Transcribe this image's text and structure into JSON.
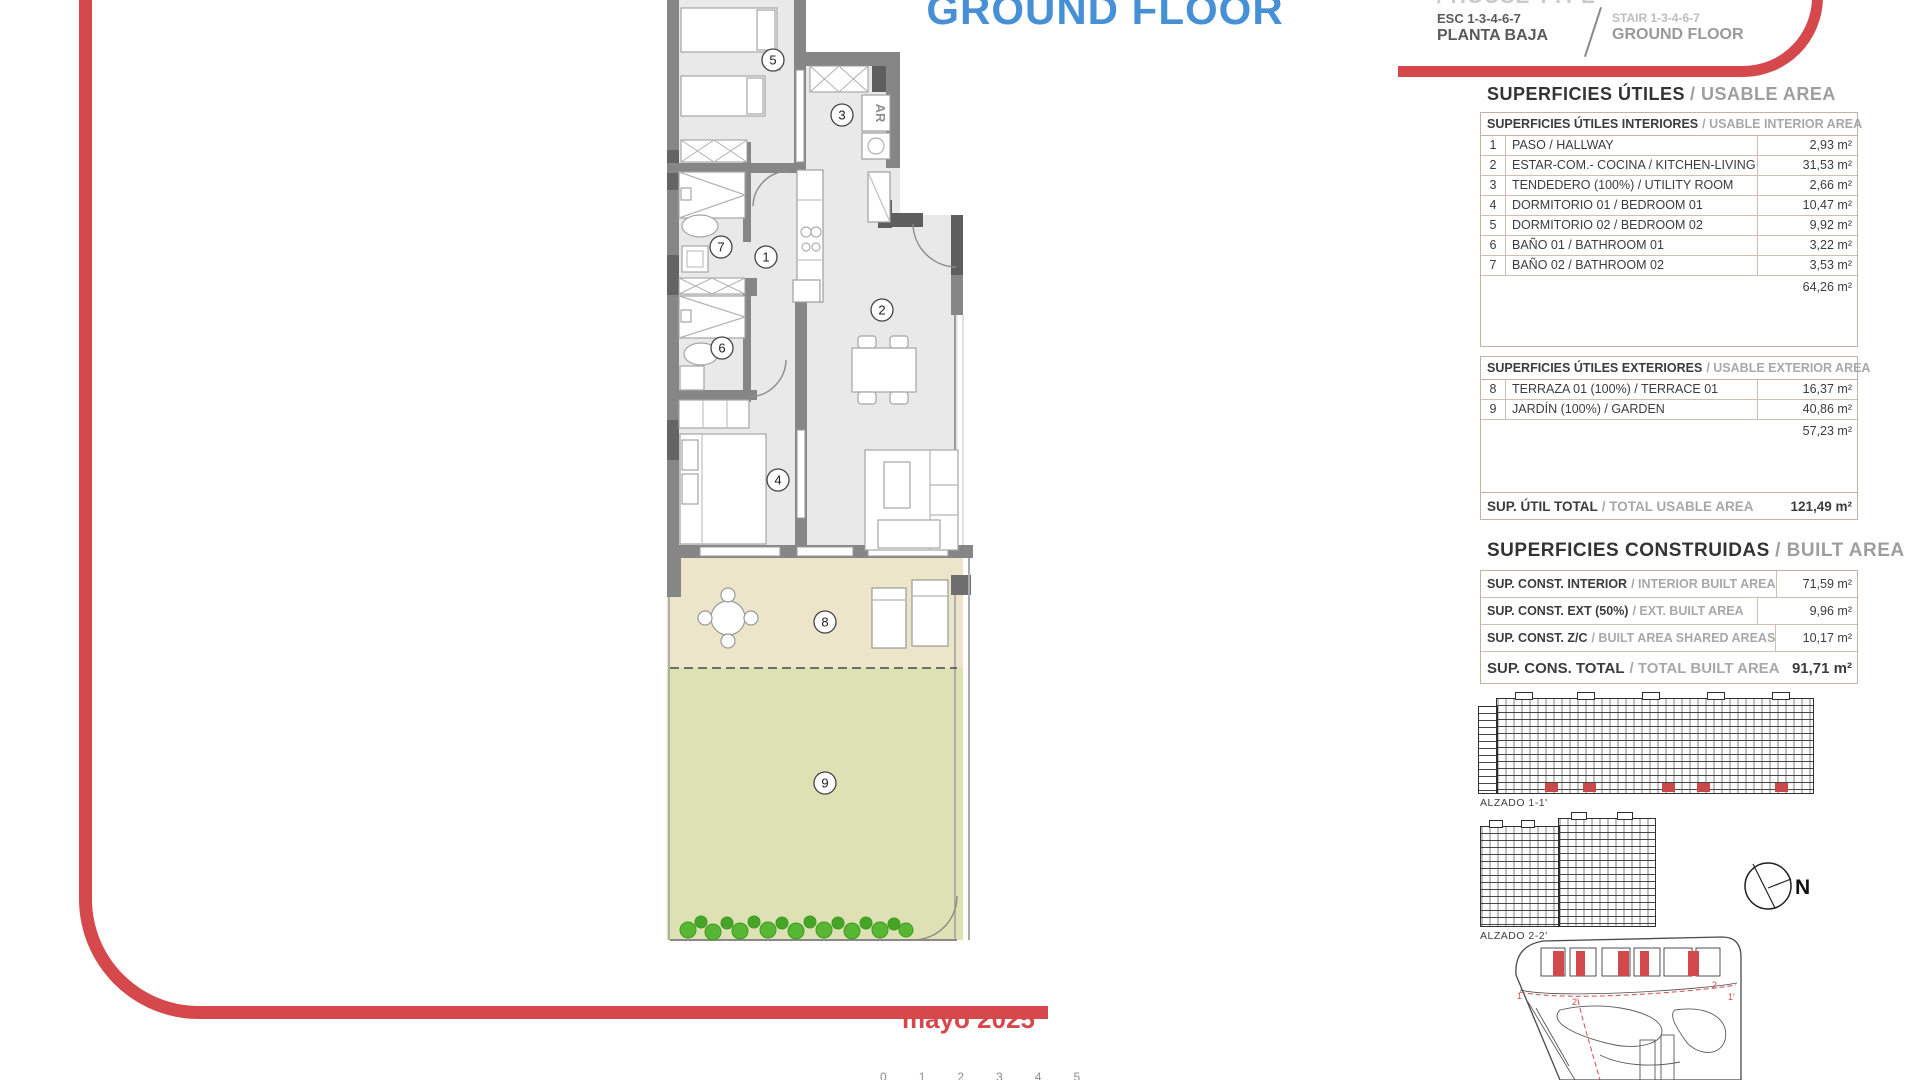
{
  "colors": {
    "accent_red": "#d5494d",
    "title_blue": "#4690d6",
    "terrace_fill": "#ece5c9",
    "garden_fill": "#dee1b3",
    "shrub_green": "#57b733"
  },
  "header": {
    "title": "GROUND FLOOR",
    "house_type_cut": "/ HOUSE TYPE",
    "badge": "1B",
    "esc_label": "ESC 1-3-4-6-7",
    "esc_sub": "PLANTA BAJA",
    "stair_label": "STAIR 1-3-4-6-7",
    "stair_sub": "GROUND FLOOR"
  },
  "usable": {
    "heading_es": "SUPERFICIES ÚTILES",
    "heading_en": "/ USABLE AREA",
    "interior_header_es": "SUPERFICIES ÚTILES INTERIORES",
    "interior_header_en": "/ USABLE INTERIOR AREA",
    "interior_rows": [
      {
        "num": "1",
        "label": "PASO / HALLWAY",
        "value": "2,93 m²"
      },
      {
        "num": "2",
        "label": "ESTAR-COM.- COCINA / KITCHEN-LIVING",
        "value": "31,53 m²"
      },
      {
        "num": "3",
        "label": "TENDEDERO (100%) / UTILITY ROOM",
        "value": "2,66 m²"
      },
      {
        "num": "4",
        "label": "DORMITORIO 01 / BEDROOM 01",
        "value": "10,47 m²"
      },
      {
        "num": "5",
        "label": "DORMITORIO 02 / BEDROOM 02",
        "value": "9,92 m²"
      },
      {
        "num": "6",
        "label": "BAÑO 01 / BATHROOM 01",
        "value": "3,22 m²"
      },
      {
        "num": "7",
        "label": "BAÑO 02 / BATHROOM 02",
        "value": "3,53 m²"
      }
    ],
    "interior_subtotal": "64,26 m²",
    "exterior_header_es": "SUPERFICIES ÚTILES EXTERIORES",
    "exterior_header_en": "/ USABLE EXTERIOR AREA",
    "exterior_rows": [
      {
        "num": "8",
        "label": "TERRAZA 01 (100%) / TERRACE 01",
        "value": "16,37 m²"
      },
      {
        "num": "9",
        "label": "JARDÍN (100%) / GARDEN",
        "value": "40,86 m²"
      }
    ],
    "exterior_subtotal": "57,23 m²",
    "total_es": "SUP. ÚTIL TOTAL",
    "total_en": "/ TOTAL USABLE AREA",
    "total_value": "121,49 m²"
  },
  "built": {
    "heading_es": "SUPERFICIES CONSTRUIDAS",
    "heading_en": "/ BUILT AREA",
    "rows": [
      {
        "label_es": "SUP. CONST. INTERIOR",
        "label_en": "/ INTERIOR BUILT AREA",
        "value": "71,59 m²"
      },
      {
        "label_es": "SUP. CONST. EXT (50%)",
        "label_en": "/ EXT. BUILT AREA",
        "value": "9,96 m²"
      },
      {
        "label_es": "SUP. CONST. Z/C",
        "label_en": "/ BUILT AREA SHARED AREAS",
        "value": "10,17 m²"
      }
    ],
    "total_es": "SUP. CONS. TOTAL",
    "total_en": "/ TOTAL BUILT AREA",
    "total_value": "91,71 m²"
  },
  "plan": {
    "rooms": [
      "1",
      "2",
      "3",
      "4",
      "5",
      "6",
      "7",
      "8",
      "9"
    ],
    "appliance_label": "AR"
  },
  "elevations": {
    "alzado1": "ALZADO 1-1'",
    "alzado2": "ALZADO 2-2'",
    "north": "N"
  },
  "site": {
    "marks": [
      "1",
      "2'",
      "2",
      "1'"
    ]
  },
  "footer": {
    "date": "mayo 2025",
    "scale": [
      "0",
      "1",
      "2",
      "3",
      "4",
      "5"
    ]
  }
}
